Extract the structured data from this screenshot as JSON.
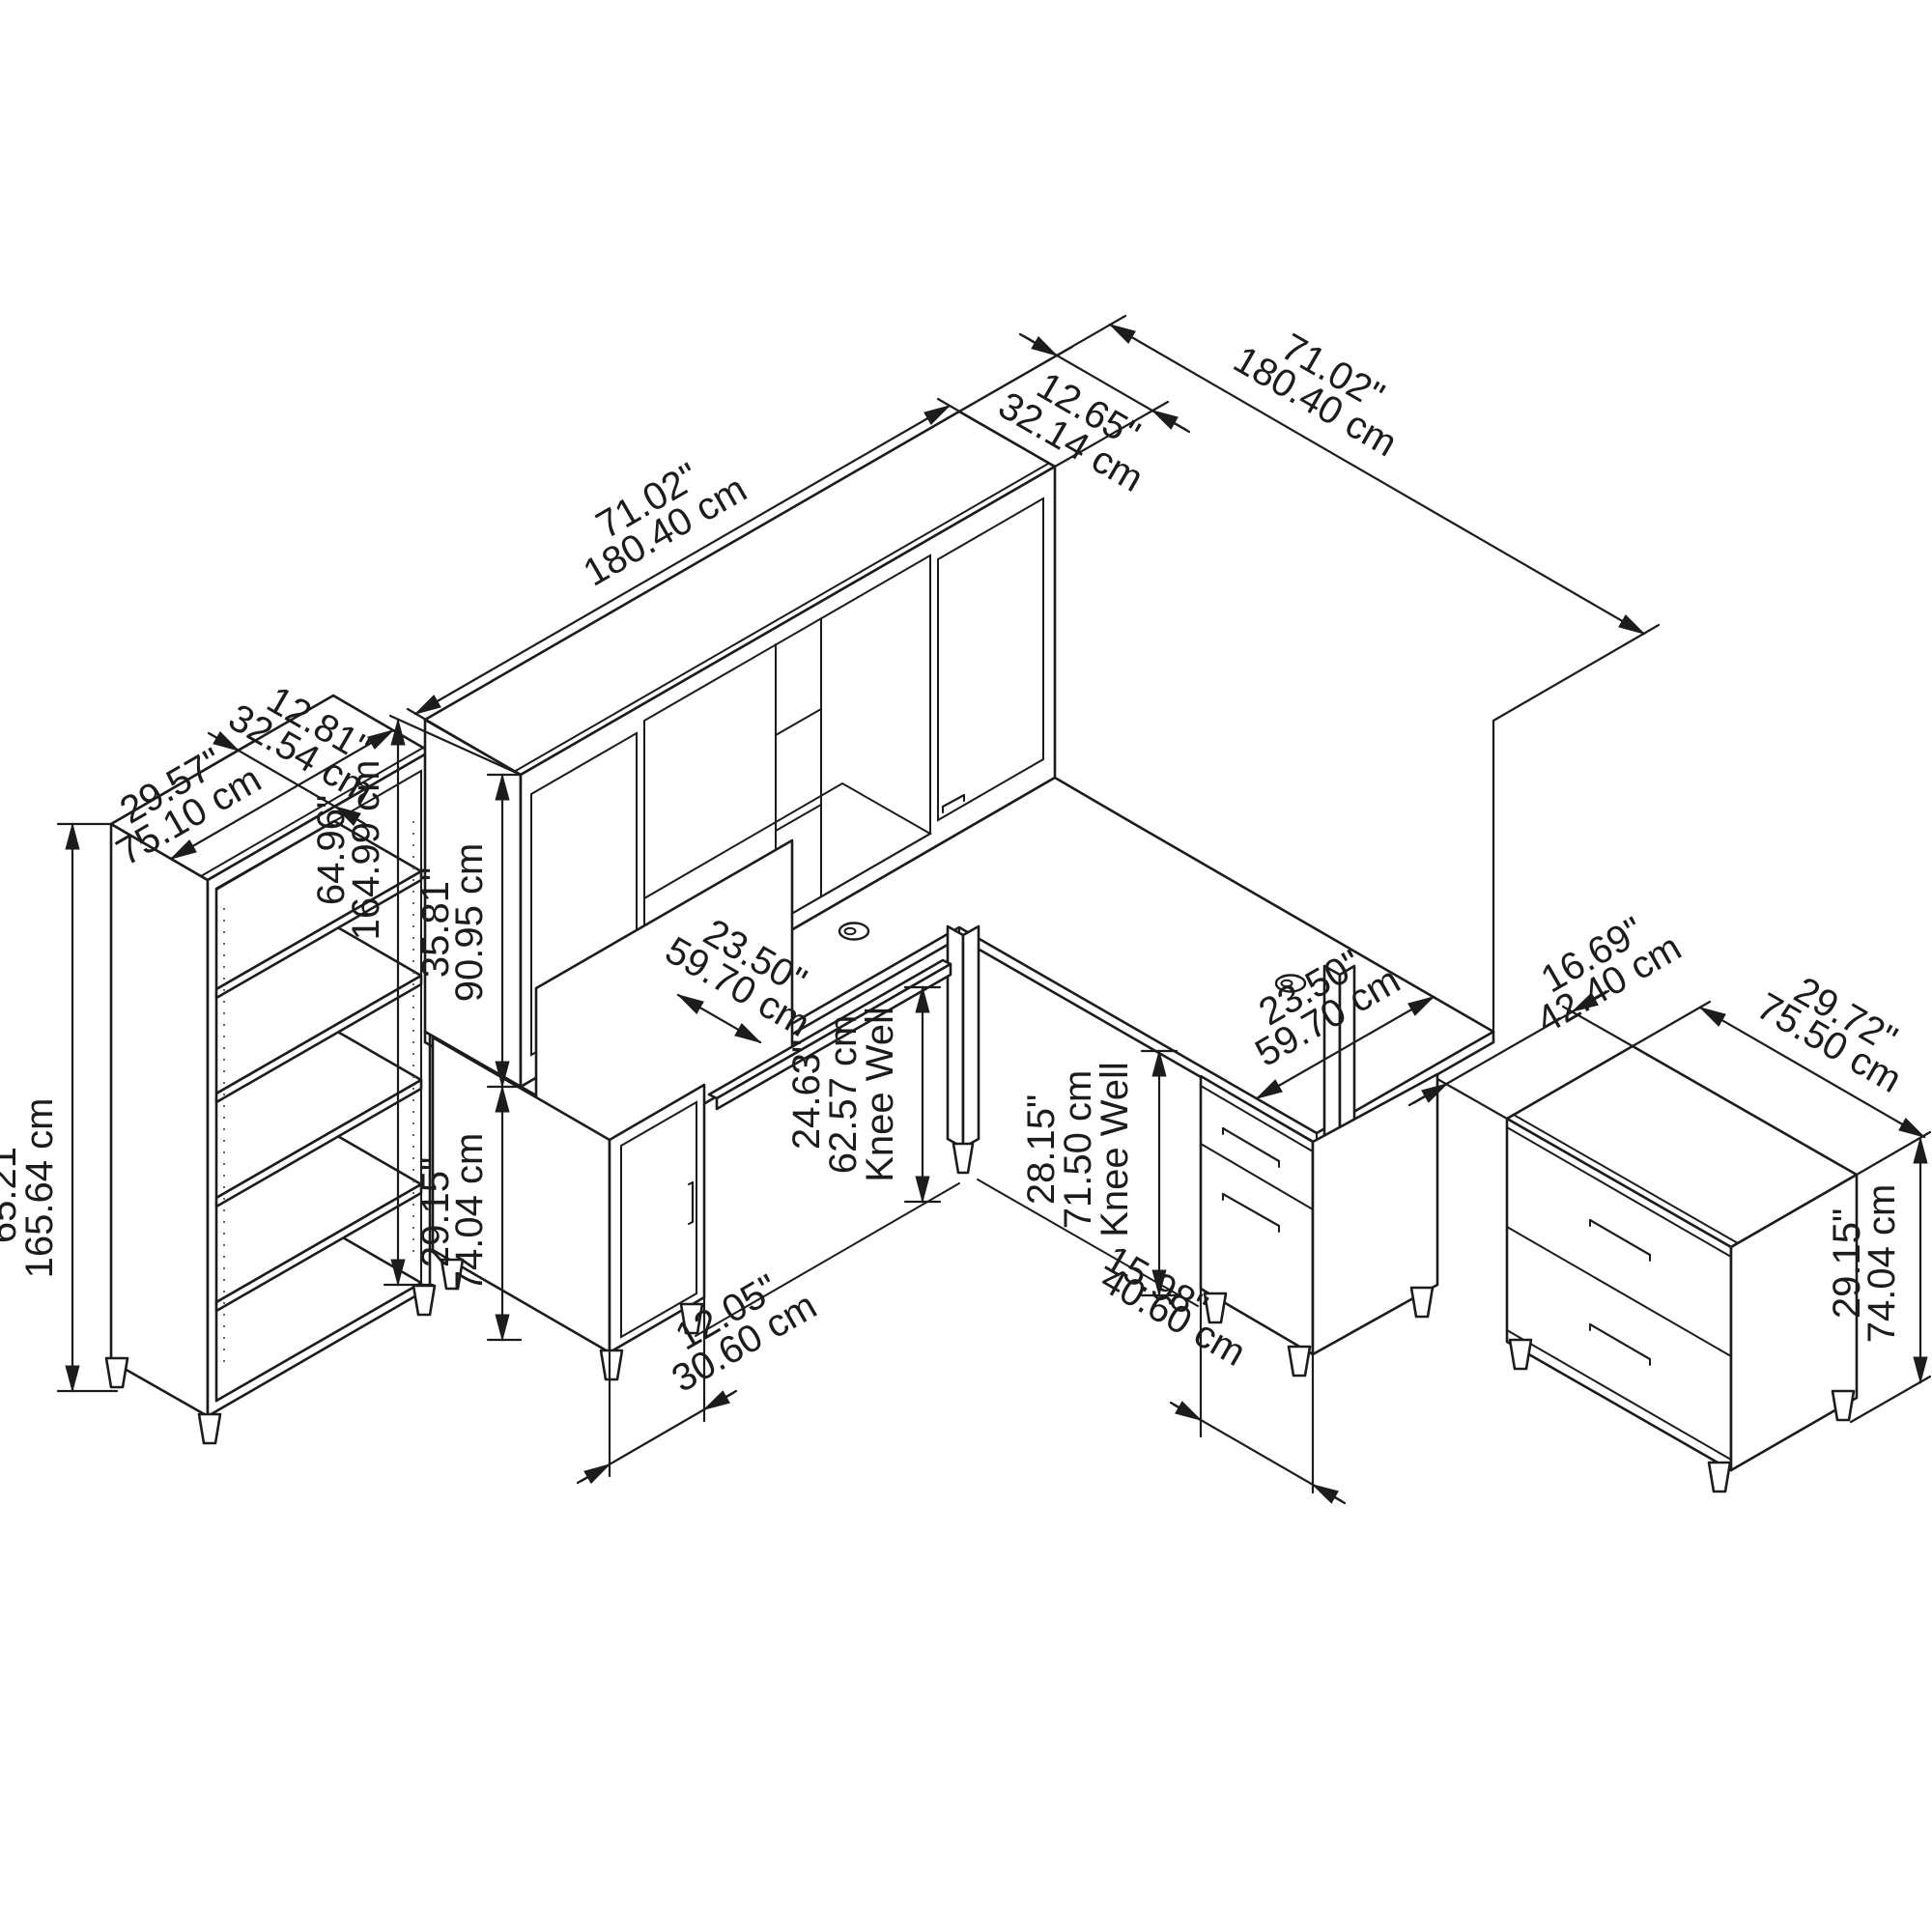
{
  "diagram": {
    "type": "isometric furniture dimension drawing",
    "colors": {
      "background": "#ffffff",
      "line": "#1c1c1c"
    },
    "pieces": [
      "bookcase",
      "l-shaped-desk-with-hutch",
      "lateral-file-cabinet"
    ],
    "dimensions": {
      "hutch_width": {
        "in": "71.02\"",
        "cm": "180.40 cm"
      },
      "hutch_depth": {
        "in": "12.65\"",
        "cm": "32.14 cm"
      },
      "return_length": {
        "in": "71.02\"",
        "cm": "180.40 cm"
      },
      "bookcase_depth": {
        "in": "12.81\"",
        "cm": "32.54 cm"
      },
      "bookcase_width": {
        "in": "29.57\"",
        "cm": "75.10 cm"
      },
      "bookcase_height": {
        "in": "65.21\"",
        "cm": "165.64 cm"
      },
      "total_height": {
        "in": "64.96\"",
        "cm": "164.99 cm"
      },
      "hutch_height": {
        "in": "35.81\"",
        "cm": "90.95 cm"
      },
      "desk_height": {
        "in": "29.15\"",
        "cm": "74.04 cm"
      },
      "desk_depth": {
        "in": "23.50\"",
        "cm": "59.70 cm"
      },
      "kneewell_left": {
        "in": "24.63\"",
        "cm": "62.57 cm",
        "label": "Knee Well"
      },
      "pedestal_width": {
        "in": "12.05\"",
        "cm": "30.60 cm"
      },
      "kneewell_right": {
        "in": "28.15\"",
        "cm": "71.50 cm",
        "label": "Knee Well"
      },
      "return_pedestal_width": {
        "in": "15.98\"",
        "cm": "40.60 cm"
      },
      "return_depth": {
        "in": "23.50\"",
        "cm": "59.70 cm"
      },
      "cabinet_depth": {
        "in": "16.69\"",
        "cm": "42.40 cm"
      },
      "cabinet_width": {
        "in": "29.72\"",
        "cm": "75.50 cm"
      },
      "cabinet_height": {
        "in": "29.15\"",
        "cm": "74.04 cm"
      }
    }
  }
}
